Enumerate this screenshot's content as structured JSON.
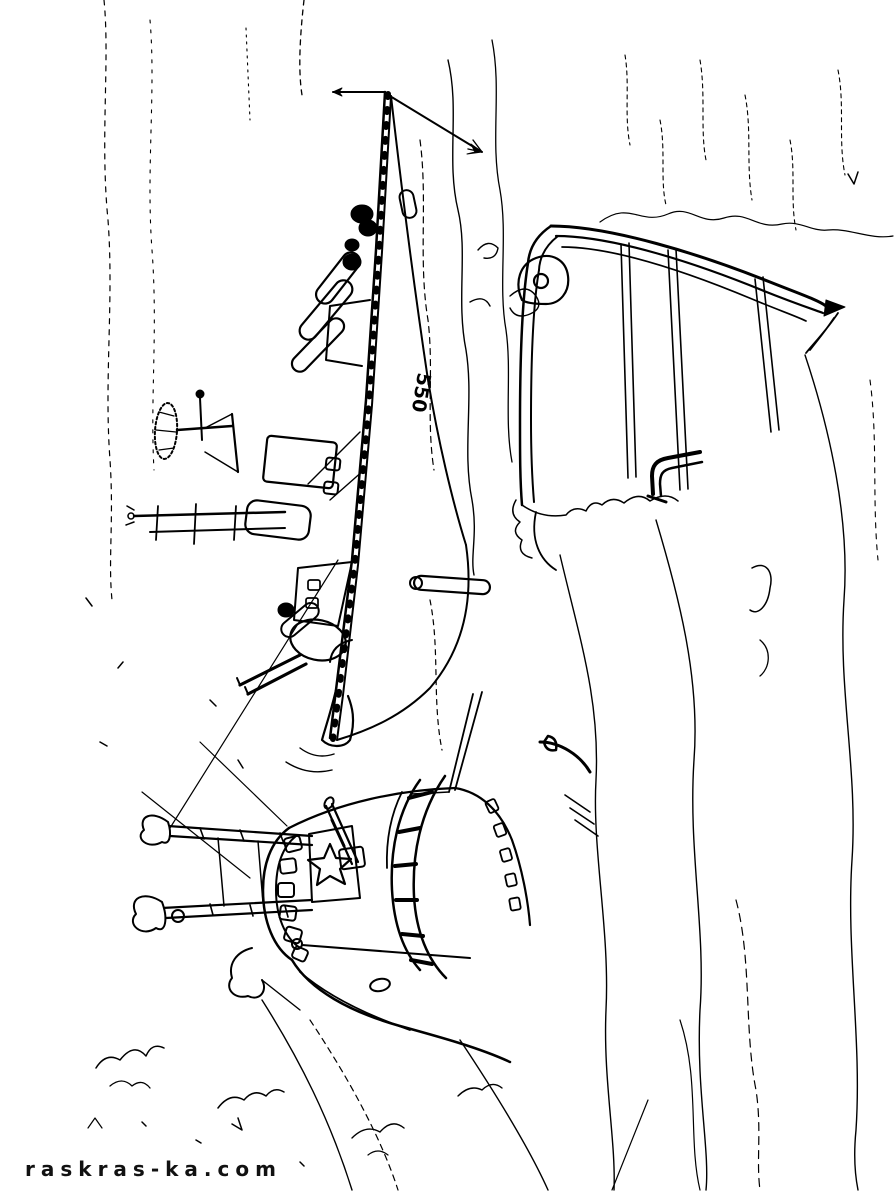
{
  "page": {
    "background": "#ffffff",
    "ink": "#000000"
  },
  "watermark": {
    "text": "raskras-ka.com"
  },
  "illustration": {
    "type": "coloring-page-line-art",
    "hull_number": "550"
  }
}
